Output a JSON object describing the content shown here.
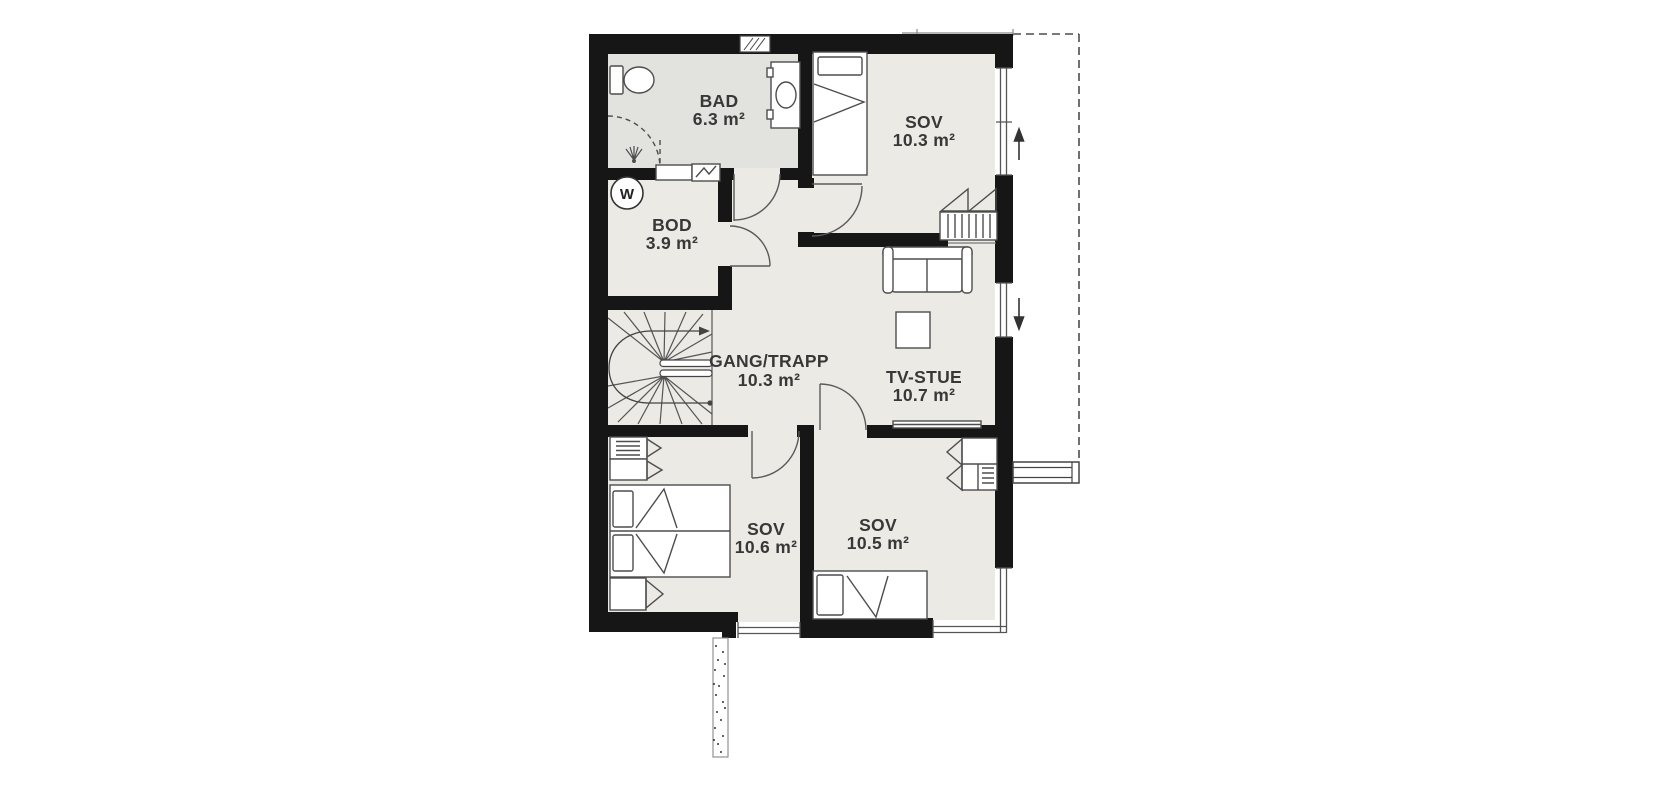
{
  "plan": {
    "rooms": [
      {
        "key": "bad",
        "name": "BAD",
        "area": "6.3 m²"
      },
      {
        "key": "sov-top",
        "name": "SOV",
        "area": "10.3 m²"
      },
      {
        "key": "bod",
        "name": "BOD",
        "area": "3.9 m²"
      },
      {
        "key": "gang-trapp",
        "name": "GANG/TRAPP",
        "area": "10.3 m²"
      },
      {
        "key": "tv-stue",
        "name": "TV-STUE",
        "area": "10.7 m²"
      },
      {
        "key": "sov-bottom-left",
        "name": "SOV",
        "area": "10.6 m²"
      },
      {
        "key": "sov-bottom-right",
        "name": "SOV",
        "area": "10.5 m²"
      }
    ],
    "symbols": {
      "water_heater": "W"
    },
    "colors": {
      "wall": "#161616",
      "floor": "#eceae5",
      "bathroom_floor": "#e2e2df",
      "furniture_outline": "#4d4d4d",
      "label_text": "#383838",
      "background": "#ffffff"
    }
  }
}
